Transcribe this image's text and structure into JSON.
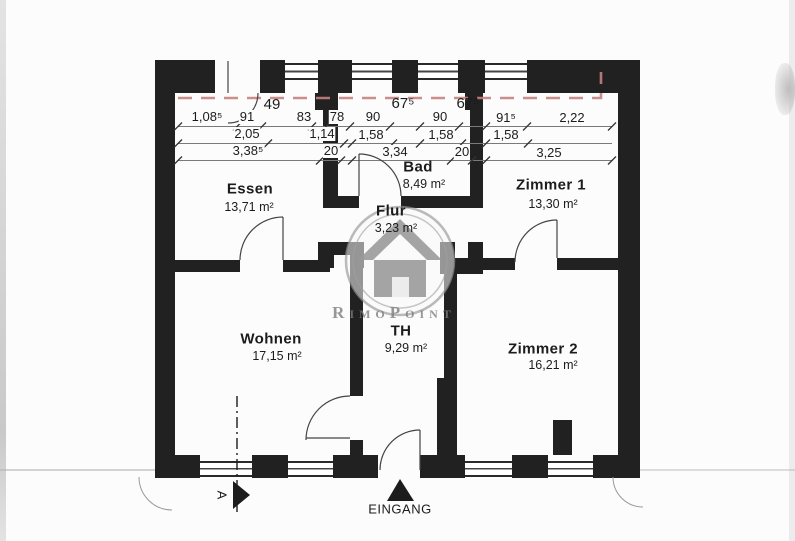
{
  "plan": {
    "rooms": [
      {
        "name": "Essen",
        "area": "13,71 m²"
      },
      {
        "name": "Bad",
        "area": "8,49 m²"
      },
      {
        "name": "Flur",
        "area": "3,23 m²"
      },
      {
        "name": "Zimmer 1",
        "area": "13,30 m²"
      },
      {
        "name": "Wohnen",
        "area": "17,15 m²"
      },
      {
        "name": "TH",
        "area": "9,29 m²"
      },
      {
        "name": "Zimmer 2",
        "area": "16,21 m²"
      }
    ],
    "dimensions": {
      "row_top": [
        "49",
        "67⁵",
        "67⁵"
      ],
      "row_1": [
        "1,08⁵",
        "91",
        "83",
        "78",
        "90",
        "90",
        "91⁵",
        "2,22"
      ],
      "row_2": [
        "2,05",
        "1,14",
        "1,58",
        "1,58",
        "1,58"
      ],
      "row_3": [
        "3,38⁵",
        "20",
        "3,34",
        "20",
        "3,25"
      ]
    },
    "labels": {
      "entrance": "EINGANG",
      "section_marker": "A"
    },
    "watermark": {
      "text": "RimoPoint"
    },
    "colors": {
      "wall": "#212121",
      "red_line": "#c4837e",
      "watermark_gray": "#9a9a9a"
    }
  }
}
